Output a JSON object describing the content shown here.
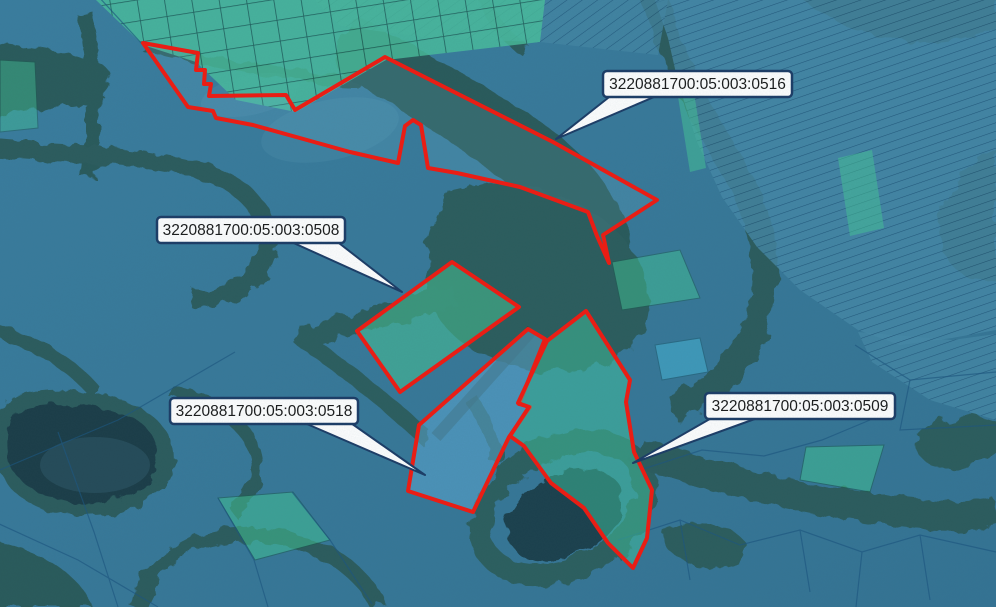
{
  "map": {
    "kind": "cadastral-satellite-map",
    "colors": {
      "selection_outline": "#f21a10",
      "callout_bg": "#ffffff",
      "callout_border": "#1c3c66",
      "callout_text": "#1a1a1a",
      "overlay_parcel_blue": "#4689a7",
      "overlay_parcel_green": "#45c497",
      "forest": "#28492f",
      "water_overlay": "#3f7e98"
    },
    "selected_parcels": [
      {
        "short_id": "0516",
        "label": "3220881700:05:003:0516",
        "fill": "rgba(125,195,215,0.16)",
        "points": [
          [
            143,
            43
          ],
          [
            198,
            53
          ],
          [
            196,
            70
          ],
          [
            205,
            70
          ],
          [
            204,
            84
          ],
          [
            211,
            84
          ],
          [
            209,
            96
          ],
          [
            286,
            95
          ],
          [
            295,
            110
          ],
          [
            385,
            57
          ],
          [
            553,
            142
          ],
          [
            657,
            200
          ],
          [
            603,
            235
          ],
          [
            609,
            263
          ],
          [
            597,
            236
          ],
          [
            588,
            212
          ],
          [
            520,
            187
          ],
          [
            457,
            173
          ],
          [
            428,
            168
          ],
          [
            421,
            125
          ],
          [
            413,
            120
          ],
          [
            405,
            126
          ],
          [
            398,
            163
          ],
          [
            350,
            152
          ],
          [
            307,
            140
          ],
          [
            253,
            125
          ],
          [
            216,
            118
          ],
          [
            213,
            111
          ],
          [
            188,
            107
          ]
        ],
        "callout": {
          "box": [
            603,
            71,
            189,
            26
          ],
          "tip": [
            556,
            139
          ],
          "attach": "bl"
        }
      },
      {
        "short_id": "0508",
        "label": "3220881700:05:003:0508",
        "fill": "rgba(72,196,148,0.55)",
        "points": [
          [
            357,
            331
          ],
          [
            452,
            262
          ],
          [
            519,
            307
          ],
          [
            400,
            392
          ]
        ],
        "callout": {
          "box": [
            157,
            217,
            188,
            26
          ],
          "tip": [
            402,
            292
          ],
          "attach": "br"
        }
      },
      {
        "short_id": "0518",
        "label": "3220881700:05:003:0518",
        "fill": "rgba(95,172,216,0.5)",
        "points": [
          [
            528,
            329
          ],
          [
            545,
            339
          ],
          [
            519,
            404
          ],
          [
            530,
            407
          ],
          [
            509,
            437
          ],
          [
            473,
            512
          ],
          [
            408,
            491
          ],
          [
            419,
            425
          ]
        ],
        "callout": {
          "box": [
            170,
            398,
            188,
            26
          ],
          "tip": [
            425,
            475
          ],
          "attach": "br"
        }
      },
      {
        "short_id": "0509",
        "label": "3220881700:05:003:0509",
        "fill": "rgba(66,198,158,0.5)",
        "points": [
          [
            547,
            341
          ],
          [
            586,
            311
          ],
          [
            630,
            380
          ],
          [
            626,
            402
          ],
          [
            634,
            452
          ],
          [
            652,
            490
          ],
          [
            647,
            538
          ],
          [
            633,
            568
          ],
          [
            608,
            543
          ],
          [
            584,
            508
          ],
          [
            551,
            483
          ],
          [
            524,
            446
          ],
          [
            510,
            436
          ],
          [
            529,
            407
          ],
          [
            518,
            403
          ]
        ],
        "callout": {
          "box": [
            705,
            393,
            190,
            26
          ],
          "tip": [
            633,
            463
          ],
          "attach": "bl"
        }
      }
    ]
  }
}
